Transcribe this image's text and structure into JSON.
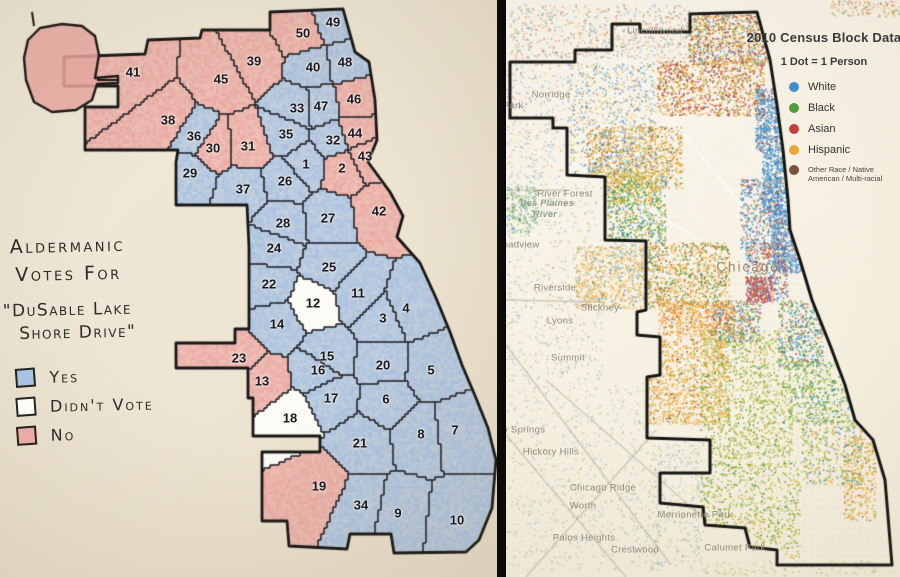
{
  "left_map": {
    "legend": {
      "title_line1": "Aldermanic",
      "title_line2": "Votes For",
      "subject_line1": "\"DuSable Lake",
      "subject_line2": "Shore Drive\"",
      "items": [
        {
          "label": "Yes",
          "vote": "yes",
          "color": "#a9c2e2"
        },
        {
          "label": "Didn't Vote",
          "vote": "none",
          "color": "#fcfbf5"
        },
        {
          "label": "No",
          "vote": "no",
          "color": "#ecaaa4"
        }
      ]
    },
    "wards": [
      {
        "num": 1,
        "vote": "yes",
        "x": 306,
        "y": 164
      },
      {
        "num": 2,
        "vote": "no",
        "x": 342,
        "y": 168
      },
      {
        "num": 3,
        "vote": "yes",
        "x": 383,
        "y": 318
      },
      {
        "num": 4,
        "vote": "yes",
        "x": 406,
        "y": 308
      },
      {
        "num": 5,
        "vote": "yes",
        "x": 431,
        "y": 370
      },
      {
        "num": 6,
        "vote": "yes",
        "x": 386,
        "y": 399
      },
      {
        "num": 7,
        "vote": "yes",
        "x": 455,
        "y": 430
      },
      {
        "num": 8,
        "vote": "yes",
        "x": 421,
        "y": 434
      },
      {
        "num": 9,
        "vote": "yes",
        "x": 398,
        "y": 513
      },
      {
        "num": 10,
        "vote": "yes",
        "x": 457,
        "y": 520
      },
      {
        "num": 11,
        "vote": "yes",
        "x": 358,
        "y": 293
      },
      {
        "num": 12,
        "vote": "none",
        "x": 313,
        "y": 303
      },
      {
        "num": 13,
        "vote": "no",
        "x": 262,
        "y": 381
      },
      {
        "num": 14,
        "vote": "yes",
        "x": 277,
        "y": 324
      },
      {
        "num": 15,
        "vote": "yes",
        "x": 327,
        "y": 356
      },
      {
        "num": 16,
        "vote": "yes",
        "x": 318,
        "y": 370
      },
      {
        "num": 17,
        "vote": "yes",
        "x": 331,
        "y": 398
      },
      {
        "num": 18,
        "vote": "none",
        "x": 290,
        "y": 418
      },
      {
        "num": 19,
        "vote": "no",
        "x": 319,
        "y": 486
      },
      {
        "num": 20,
        "vote": "yes",
        "x": 383,
        "y": 365
      },
      {
        "num": 21,
        "vote": "yes",
        "x": 360,
        "y": 443
      },
      {
        "num": 22,
        "vote": "yes",
        "x": 269,
        "y": 284
      },
      {
        "num": 23,
        "vote": "no",
        "x": 239,
        "y": 358
      },
      {
        "num": 24,
        "vote": "yes",
        "x": 274,
        "y": 248
      },
      {
        "num": 25,
        "vote": "yes",
        "x": 329,
        "y": 267
      },
      {
        "num": 26,
        "vote": "yes",
        "x": 285,
        "y": 181
      },
      {
        "num": 27,
        "vote": "yes",
        "x": 328,
        "y": 218
      },
      {
        "num": 28,
        "vote": "yes",
        "x": 283,
        "y": 223
      },
      {
        "num": 29,
        "vote": "yes",
        "x": 190,
        "y": 173
      },
      {
        "num": 30,
        "vote": "no",
        "x": 213,
        "y": 148
      },
      {
        "num": 31,
        "vote": "no",
        "x": 248,
        "y": 146
      },
      {
        "num": 32,
        "vote": "yes",
        "x": 333,
        "y": 140
      },
      {
        "num": 33,
        "vote": "yes",
        "x": 297,
        "y": 108
      },
      {
        "num": 34,
        "vote": "yes",
        "x": 361,
        "y": 505
      },
      {
        "num": 35,
        "vote": "yes",
        "x": 286,
        "y": 134
      },
      {
        "num": 36,
        "vote": "yes",
        "x": 194,
        "y": 136
      },
      {
        "num": 37,
        "vote": "yes",
        "x": 243,
        "y": 189
      },
      {
        "num": 38,
        "vote": "no",
        "x": 168,
        "y": 120
      },
      {
        "num": 39,
        "vote": "no",
        "x": 254,
        "y": 61
      },
      {
        "num": 40,
        "vote": "yes",
        "x": 313,
        "y": 67
      },
      {
        "num": 41,
        "vote": "no",
        "x": 133,
        "y": 72
      },
      {
        "num": 42,
        "vote": "no",
        "x": 379,
        "y": 211
      },
      {
        "num": 43,
        "vote": "no",
        "x": 365,
        "y": 156
      },
      {
        "num": 44,
        "vote": "no",
        "x": 355,
        "y": 133
      },
      {
        "num": 45,
        "vote": "no",
        "x": 221,
        "y": 79
      },
      {
        "num": 46,
        "vote": "no",
        "x": 354,
        "y": 99
      },
      {
        "num": 47,
        "vote": "yes",
        "x": 321,
        "y": 106
      },
      {
        "num": 48,
        "vote": "yes",
        "x": 345,
        "y": 62
      },
      {
        "num": 49,
        "vote": "yes",
        "x": 333,
        "y": 22
      },
      {
        "num": 50,
        "vote": "no",
        "x": 303,
        "y": 33
      }
    ]
  },
  "right_map": {
    "legend": {
      "title": "2010 Census Block Data",
      "subtitle": "1 Dot = 1 Person",
      "items": [
        {
          "label": "White",
          "color": "#3f8fce"
        },
        {
          "label": "Black",
          "color": "#4f9a3a"
        },
        {
          "label": "Asian",
          "color": "#c2423a"
        },
        {
          "label": "Hispanic",
          "color": "#f0a636"
        },
        {
          "label": "Other Race / Native American / Multi-racial",
          "color": "#7d5340"
        }
      ]
    },
    "places": [
      {
        "name": "Lincolnwood",
        "x": 655,
        "y": 31,
        "style": "town"
      },
      {
        "name": "Norridge",
        "x": 551,
        "y": 95,
        "style": "town"
      },
      {
        "name": "Park",
        "x": 513,
        "y": 106,
        "style": "town"
      },
      {
        "name": "River Forest",
        "x": 565,
        "y": 194,
        "style": "town"
      },
      {
        "name": "Des Plaines",
        "x": 547,
        "y": 203,
        "style": "river"
      },
      {
        "name": "River",
        "x": 545,
        "y": 214,
        "style": "river"
      },
      {
        "name": "Broadview",
        "x": 516,
        "y": 245,
        "style": "town"
      },
      {
        "name": "Riverside",
        "x": 555,
        "y": 288,
        "style": "town"
      },
      {
        "name": "Stickney",
        "x": 600,
        "y": 308,
        "style": "town"
      },
      {
        "name": "Lyons",
        "x": 560,
        "y": 321,
        "style": "town"
      },
      {
        "name": "Summit",
        "x": 568,
        "y": 358,
        "style": "town"
      },
      {
        "name": "Chicago",
        "x": 748,
        "y": 267,
        "style": "city"
      },
      {
        "name": "Willow Springs",
        "x": 512,
        "y": 430,
        "style": "town"
      },
      {
        "name": "Hickory Hills",
        "x": 551,
        "y": 452,
        "style": "town"
      },
      {
        "name": "Chicago Ridge",
        "x": 603,
        "y": 488,
        "style": "town"
      },
      {
        "name": "Worth",
        "x": 583,
        "y": 506,
        "style": "town"
      },
      {
        "name": "Palos Heights",
        "x": 584,
        "y": 538,
        "style": "town"
      },
      {
        "name": "Crestwood",
        "x": 635,
        "y": 550,
        "style": "town"
      },
      {
        "name": "Merrionette Park",
        "x": 695,
        "y": 515,
        "style": "town"
      },
      {
        "name": "Calumet Park",
        "x": 735,
        "y": 548,
        "style": "town"
      }
    ]
  }
}
